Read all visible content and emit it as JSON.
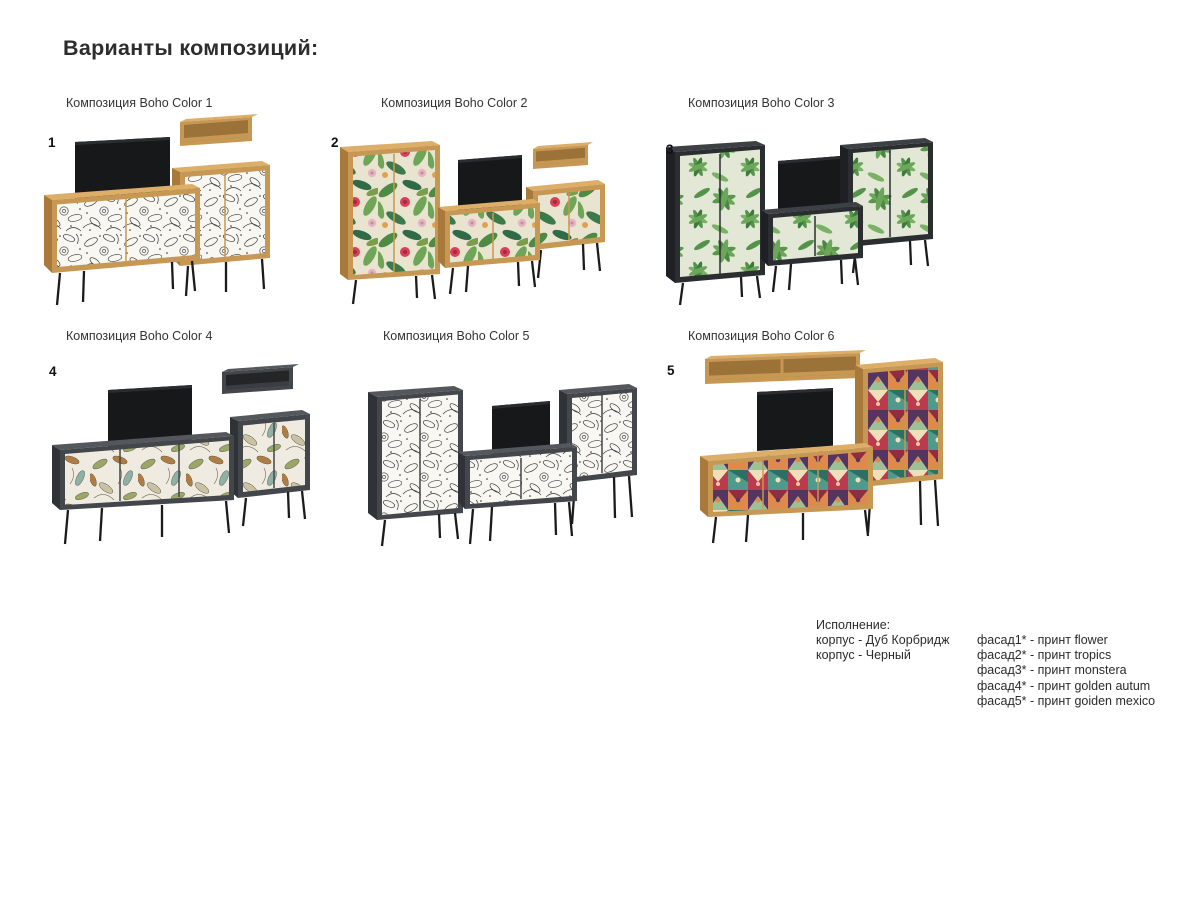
{
  "page": {
    "title": "Варианты композиций:"
  },
  "compositions": [
    {
      "number": "1",
      "label": "Композиция Boho Color 1",
      "print": "flower",
      "body": "oak"
    },
    {
      "number": "2",
      "label": "Композиция Boho Color 2",
      "print": "tropics",
      "body": "oak"
    },
    {
      "number": "3",
      "label": "Композиция Boho Color 3",
      "print": "monstera",
      "body": "black"
    },
    {
      "number": "4",
      "label": "Композиция Boho Color 4",
      "print": "golden autum",
      "body": "black"
    },
    {
      "number": "",
      "label": "Композиция Boho Color 5",
      "print": "flower",
      "body": "black"
    },
    {
      "number": "5",
      "label": "Композиция Boho Color 6",
      "print": "goiden mexico",
      "body": "oak"
    }
  ],
  "legend": {
    "title": "Исполнение:",
    "body_lines": [
      "корпус - Дуб Корбридж",
      "корпус - Черный"
    ],
    "facade_lines": [
      "фасад1* - принт flower",
      "фасад2* - принт tropics",
      "фасад3* - принт monstera",
      "фасад4* - принт golden autum",
      "фасад5* - принт goiden mexico"
    ]
  },
  "colors": {
    "background": "#ffffff",
    "text": "#2d2d2d",
    "oak": "#c79754",
    "oak_top": "#dcae68",
    "oak_side": "#a9793b",
    "dark_body": "#43474b",
    "darker_body": "#2b2e31",
    "tv": "#17181a",
    "leg": "#1b1b1b",
    "print_flower_bg": "#f8f7f2",
    "print_tropics_green": "#4d8a44",
    "print_tropics_red": "#d84058",
    "print_monstera_bg": "#e2e7d6",
    "print_autumn_bg": "#f0ebe0",
    "print_mexico_red": "#bb3a4e",
    "print_mexico_teal": "#4f9a8b"
  }
}
